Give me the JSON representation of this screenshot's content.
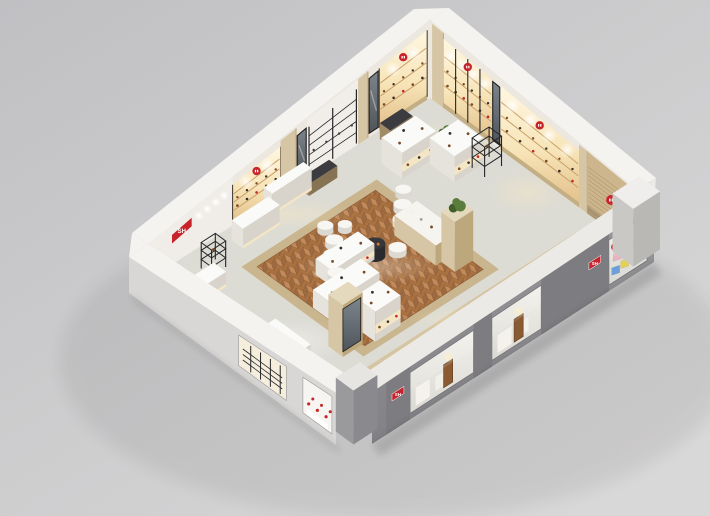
{
  "meta": {
    "description": "Isometric 3D render of a retail store interior (dollhouse cutaway view)"
  },
  "logo": {
    "text": "SH",
    "bg": "#c8232b",
    "fg": "#ffffff"
  },
  "background": {
    "top_left": "#c0c0c3",
    "bottom_right": "#d9d8d8"
  },
  "palette": {
    "wall": "#ece8e0",
    "cap": "#f4f3f0",
    "wood": "#d6c6a5",
    "woodDark": "#bda77d",
    "woodPlinth": "#c4ae84",
    "glowLine": "#c9a06a",
    "tile": "#dcdbd4",
    "woodStrip": "#d5c49f",
    "woodStrip2": "#c9b58e",
    "herrA": "#c28a5a",
    "herrB": "#9c6a41",
    "herrBase": "#a9713f",
    "herrLine": "#8a5a35",
    "grayWall": "#8f8f92",
    "grayWallDark": "#7d7d81",
    "grayCap": "#eceae7",
    "glass": "#eceae5",
    "black": "#26262a",
    "mirrorHi": "#7d858c",
    "mirrorLo": "#4e545a",
    "red": "#c8232b",
    "white": "#fafaf8",
    "whiteL": "#e6e3dc",
    "whiteF": "#d8d4cb",
    "door": "#8a5a33",
    "plant1": "#5a7d3c",
    "plant2": "#41602c",
    "prod": "#7a4a26",
    "slat": "#cdb68e",
    "slatLine": "#b39b72",
    "poufSide": "#dcd9d2",
    "poufTop": "#f7f6f2",
    "poufGraySide": "#b9b8b3",
    "poufGrayTop": "#d3d2cd",
    "tableSide": "#2b2b2f",
    "tableTop": "#36363b",
    "benchTop": "#3c3b40",
    "benchL": "#a08d68",
    "benchF": "#857354",
    "ivory": "#f6e7c4",
    "frontLeftWall": "#d8d7d5"
  },
  "scene": {
    "herringbone": {
      "a": [
        0.24,
        0.66
      ],
      "b": [
        0.2,
        0.72
      ]
    },
    "herr_border": {
      "a": [
        0.21,
        0.69
      ],
      "b": [
        0.165,
        0.755
      ]
    },
    "wood_strips": [
      {
        "a": [
          0.02,
          0.1
        ],
        "b": [
          0.04,
          0.96
        ]
      },
      {
        "a": [
          0.1,
          0.95
        ],
        "b": [
          0.8,
          0.92
        ]
      }
    ],
    "floor_glows": [
      {
        "a": 0.42,
        "b": 0.07,
        "rx": 80,
        "ry": 16,
        "warm": true
      },
      {
        "a": 0.88,
        "b": 0.08,
        "rx": 40,
        "ry": 12,
        "warm": true
      },
      {
        "a": 0.95,
        "b": 0.25,
        "rx": 30,
        "ry": 24,
        "warm": true
      },
      {
        "a": 0.94,
        "b": 0.55,
        "rx": 40,
        "ry": 22,
        "warm": true
      },
      {
        "a": 0.5,
        "b": 0.86,
        "rx": 60,
        "ry": 14,
        "warm": true
      },
      {
        "a": 0.12,
        "b": 0.55,
        "rx": 50,
        "ry": 24,
        "warm": false
      },
      {
        "a": 0.45,
        "b": 0.45,
        "rx": 70,
        "ry": 18,
        "warm": false
      }
    ],
    "wall_back_left_sections": [
      {
        "type": "plain",
        "a": [
          0.0,
          0.3
        ],
        "sign": true
      },
      {
        "type": "shelf_wood",
        "a": [
          0.3,
          0.47
        ],
        "logo": true
      },
      {
        "type": "pilaster",
        "a": [
          0.47,
          0.525
        ]
      },
      {
        "type": "mirror",
        "a": [
          0.525,
          0.565
        ]
      },
      {
        "type": "shelf_black",
        "a": [
          0.565,
          0.745
        ]
      },
      {
        "type": "pilaster",
        "a": [
          0.745,
          0.78
        ]
      },
      {
        "type": "mirror",
        "a": [
          0.78,
          0.82
        ]
      },
      {
        "type": "shelf_wood",
        "a": [
          0.82,
          0.99
        ],
        "logo": true
      }
    ],
    "wall_back_right_sections": [
      {
        "type": "pilaster",
        "b": [
          0.01,
          0.065
        ]
      },
      {
        "type": "shelf_black_framed",
        "b": [
          0.065,
          0.3
        ],
        "logo": true
      },
      {
        "type": "mirror",
        "b": [
          0.3,
          0.34
        ]
      },
      {
        "type": "shelf_wood",
        "b": [
          0.34,
          0.72
        ],
        "logo": true
      },
      {
        "type": "pilaster",
        "b": [
          0.72,
          0.76
        ]
      },
      {
        "type": "slat_wood",
        "b": [
          0.76,
          0.99
        ],
        "logo": true
      }
    ],
    "front_right_wall": {
      "pilasters": [
        [
          0.05,
          0.135
        ],
        [
          0.36,
          0.425
        ],
        [
          0.6,
          0.84
        ]
      ],
      "badges": [
        {
          "a": 0.092,
          "h": 30
        },
        {
          "a": 0.79,
          "h": 34
        }
      ],
      "bays": [
        {
          "a": [
            0.135,
            0.36
          ],
          "door": 0.27,
          "boards": true
        },
        {
          "a": [
            0.425,
            0.6
          ],
          "door": 0.52,
          "boards": true
        },
        {
          "a": [
            0.84,
            0.975
          ],
          "cubes": true
        }
      ]
    },
    "cubes": [
      {
        "a": 0.855,
        "h": 27,
        "color": "#e9b3c0"
      },
      {
        "a": 0.888,
        "h": 28,
        "color": "#f0ede6"
      },
      {
        "a": 0.92,
        "h": 29,
        "color": "#a6cb80"
      },
      {
        "a": 0.85,
        "h": 14,
        "color": "#6f9fd8"
      },
      {
        "a": 0.882,
        "h": 15,
        "color": "#e4d054"
      },
      {
        "a": 0.914,
        "h": 16,
        "color": "#f0ede6"
      }
    ],
    "front_left_wall": {
      "windows": [
        {
          "b": [
            0.53,
            0.76
          ],
          "style": "rack"
        },
        {
          "b": [
            0.84,
            0.98
          ],
          "style": "shoes"
        }
      ]
    },
    "fixtures": [
      {
        "name": "display-table",
        "type": "bench",
        "a": 0.8,
        "b": 0.03,
        "da": 0.08,
        "db": 0.05,
        "h": 16
      },
      {
        "name": "floor-plant",
        "type": "plant",
        "a": 0.93,
        "b": 0.17
      },
      {
        "name": "display-gondola",
        "type": "gondola_white",
        "a": 0.74,
        "b": 0.12,
        "da": 0.12,
        "db": 0.1,
        "h": 26
      },
      {
        "name": "display-gondola",
        "type": "gondola_white",
        "a": 0.83,
        "b": 0.23,
        "da": 0.1,
        "db": 0.12,
        "h": 26
      },
      {
        "name": "metal-rack",
        "type": "rack_black",
        "a": 0.9,
        "b": 0.34,
        "da": 0.06,
        "db": 0.06,
        "h": 30
      },
      {
        "name": "bench",
        "type": "bench",
        "a": 0.52,
        "b": 0.03,
        "da": 0.1,
        "db": 0.04,
        "h": 12
      },
      {
        "name": "back-counter",
        "type": "counter",
        "a": 0.4,
        "b": 0.015,
        "da": 0.14,
        "db": 0.04,
        "h": 22
      },
      {
        "name": "pouf",
        "type": "pouf",
        "a": 0.7,
        "b": 0.28,
        "r": 8
      },
      {
        "name": "pouf",
        "type": "pouf",
        "a": 0.66,
        "b": 0.33,
        "r": 9
      },
      {
        "name": "cashier-desk",
        "type": "counter",
        "a": 0.26,
        "b": 0.05,
        "da": 0.13,
        "db": 0.055,
        "h": 20
      },
      {
        "name": "pouf",
        "type": "pouf",
        "a": 0.62,
        "b": 0.38,
        "r": 9
      },
      {
        "name": "pouf",
        "type": "pouf",
        "a": 0.46,
        "b": 0.23,
        "r": 8
      },
      {
        "name": "pouf",
        "type": "pouf",
        "a": 0.5,
        "b": 0.27,
        "r": 7
      },
      {
        "name": "pouf",
        "type": "pouf",
        "a": 0.54,
        "b": 0.47,
        "r": 9
      },
      {
        "name": "pouf",
        "type": "pouf",
        "a": 0.44,
        "b": 0.3,
        "r": 9
      },
      {
        "name": "display-gondola",
        "type": "gondola_wood",
        "a": 0.58,
        "b": 0.4,
        "da": 0.08,
        "db": 0.2,
        "h": 20
      },
      {
        "name": "round-table",
        "type": "table_black",
        "a": 0.49,
        "b": 0.43,
        "r": 10
      },
      {
        "name": "plant-column",
        "type": "column_plant",
        "a": 0.6,
        "b": 0.6,
        "da": 0.065,
        "db": 0.065,
        "h": 50
      },
      {
        "name": "pouf",
        "type": "pouf",
        "a": 0.4,
        "b": 0.35,
        "r": 10
      },
      {
        "name": "round-table",
        "type": "table_black",
        "a": 0.43,
        "b": 0.41,
        "r": 9
      },
      {
        "name": "metal-rack",
        "type": "rack_black",
        "a": 0.13,
        "b": 0.08,
        "da": 0.05,
        "db": 0.05,
        "h": 26
      },
      {
        "name": "display-gondola",
        "type": "gondola_white",
        "a": 0.33,
        "b": 0.36,
        "da": 0.15,
        "db": 0.08,
        "h": 16
      },
      {
        "name": "pouf",
        "type": "pouf",
        "a": 0.36,
        "b": 0.42,
        "r": 9
      },
      {
        "name": "side-table",
        "type": "counter",
        "a": 0.06,
        "b": 0.14,
        "da": 0.07,
        "db": 0.06,
        "h": 15
      },
      {
        "name": "pouf",
        "type": "pouf",
        "a": 0.33,
        "b": 0.46,
        "r": 8,
        "gray": true
      },
      {
        "name": "display-gondola",
        "type": "gondola_white",
        "a": 0.24,
        "b": 0.47,
        "da": 0.17,
        "db": 0.09,
        "h": 18
      },
      {
        "name": "shelf-gondola",
        "type": "shelf_gondola",
        "a": 0.27,
        "b": 0.63,
        "da": 0.09,
        "db": 0.1,
        "h": 30
      },
      {
        "name": "mirror-tower",
        "type": "tower_mirror",
        "a": 0.17,
        "b": 0.64,
        "da": 0.07,
        "db": 0.07,
        "h": 52
      },
      {
        "name": "window-counter",
        "type": "counter",
        "a": 0.035,
        "b": 0.5,
        "da": 0.05,
        "db": 0.17,
        "h": 22
      }
    ]
  }
}
